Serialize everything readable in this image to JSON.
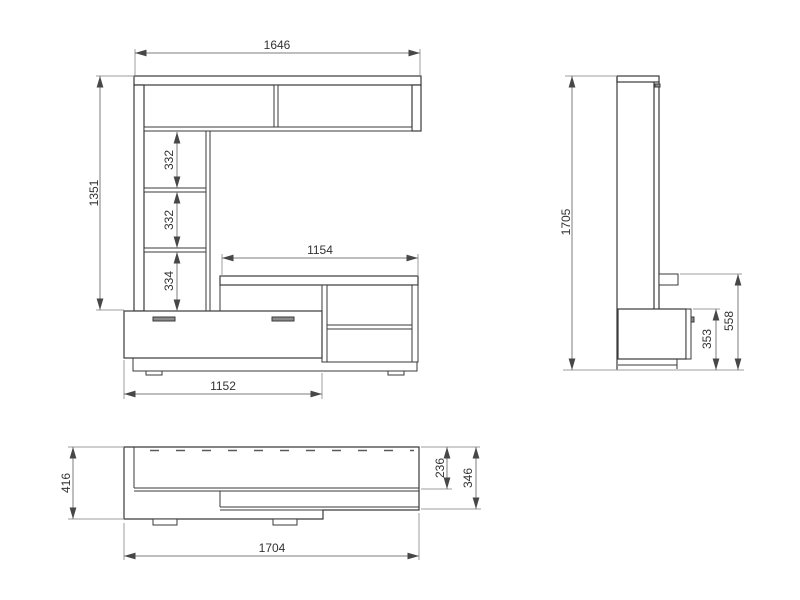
{
  "colors": {
    "background": "#ffffff",
    "object_line": "#3a3a3a",
    "dimension_line": "#7d7d7d",
    "extension_line": "#9e9e9e",
    "arrow": "#474747",
    "text": "#333333",
    "handle_fill": "#8c8c8c"
  },
  "views": {
    "front": {
      "name": "front-elevation",
      "dim_total_width": "1646",
      "dim_left_height": "1351",
      "dim_shelf_gap_top": "332",
      "dim_shelf_gap_middle": "332",
      "dim_shelf_gap_bottom": "334",
      "dim_bench_top_width": "1154",
      "dim_drawer_width": "1152"
    },
    "side": {
      "name": "side-elevation",
      "dim_total_height": "1705",
      "dim_drawer_front_height": "353",
      "dim_bench_height": "558"
    },
    "plan": {
      "name": "top-plan",
      "dim_total_depth": "416",
      "dim_upper_section_depth": "236",
      "dim_bench_depth": "346",
      "dim_total_width": "1704"
    }
  }
}
